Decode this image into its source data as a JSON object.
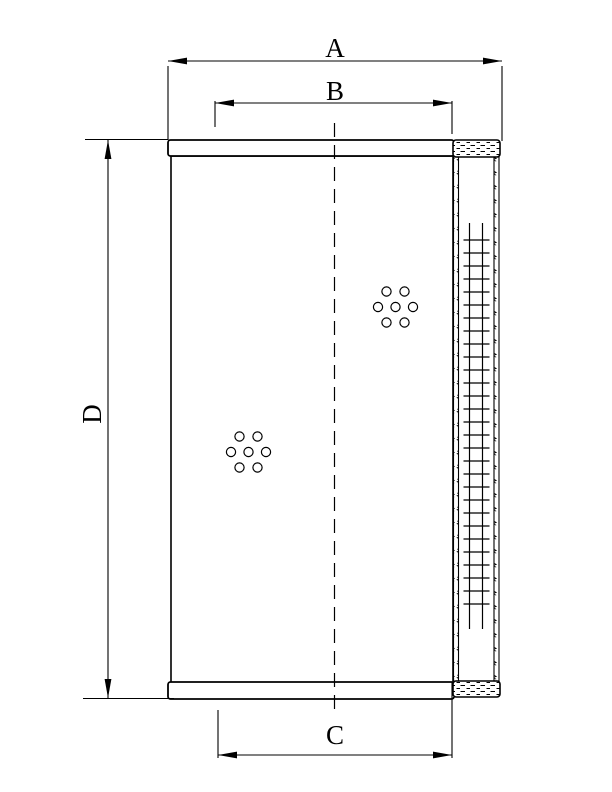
{
  "drawing": {
    "type": "technical-drawing",
    "subject": "cylindrical hydraulic filter element, side view with partial section",
    "background_color": "#ffffff",
    "line_color": "#000000",
    "dimensions": {
      "A": {
        "label": "A",
        "orientation": "horizontal",
        "position": "top-outer-width"
      },
      "B": {
        "label": "B",
        "orientation": "horizontal",
        "position": "top-inner-width"
      },
      "C": {
        "label": "C",
        "orientation": "horizontal",
        "position": "bottom-inner-width"
      },
      "D": {
        "label": "D",
        "orientation": "vertical",
        "position": "left-overall-height"
      }
    },
    "features": {
      "hole_clusters": [
        {
          "name": "upper-right-hole-cluster",
          "hole_count": 7,
          "arrangement": "hexagonal"
        },
        {
          "name": "lower-left-hole-cluster",
          "hole_count": 7,
          "arrangement": "hexagonal"
        }
      ],
      "centerline": "vertical dashed centerline",
      "media_section": {
        "description": "pleated filter media shown as ladder cross-hatch between stippled walls",
        "rung_count": 29
      },
      "end_caps": [
        "top-end-cap",
        "bottom-end-cap",
        "stippled-top-cap",
        "stippled-bottom-cap"
      ]
    }
  }
}
